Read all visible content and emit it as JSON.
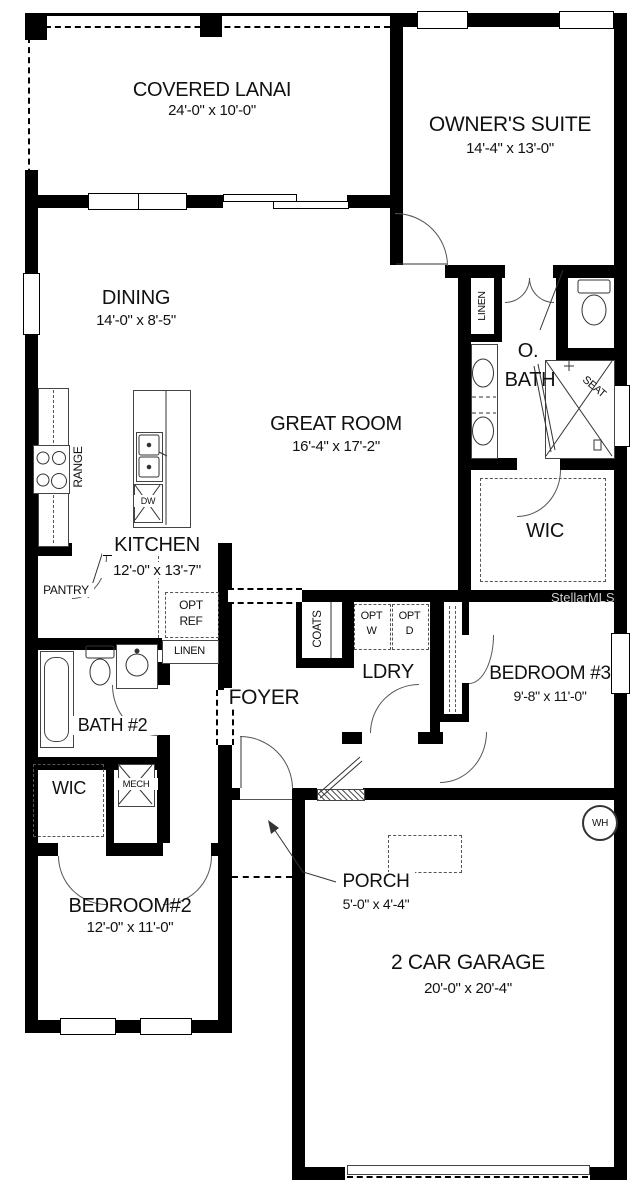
{
  "watermark": "StellarMLS",
  "rooms": {
    "lanai": {
      "name": "COVERED LANAI",
      "dims": "24'-0\" x 10'-0\""
    },
    "owners_suite": {
      "name": "OWNER'S SUITE",
      "dims": "14'-4\" x 13'-0\""
    },
    "dining": {
      "name": "DINING",
      "dims": "14'-0\" x 8'-5\""
    },
    "great_room": {
      "name": "GREAT ROOM",
      "dims": "16'-4\" x 17'-2\""
    },
    "kitchen": {
      "name": "KITCHEN",
      "dims": "12'-0\" x 13'-7\""
    },
    "owners_bath": {
      "line1": "O.",
      "line2": "BATH"
    },
    "owners_wic": {
      "name": "WIC"
    },
    "laundry": {
      "name": "LDRY"
    },
    "foyer": {
      "name": "FOYER"
    },
    "bedroom3": {
      "name": "BEDROOM #3",
      "dims": "9'-8\" x 11'-0\""
    },
    "bath2": {
      "name": "BATH #2"
    },
    "wic2": {
      "name": "WIC"
    },
    "bedroom2": {
      "name": "BEDROOM#2",
      "dims": "12'-0\" x 11'-0\""
    },
    "porch": {
      "name": "PORCH",
      "dims": "5'-0\" x 4'-4\""
    },
    "garage": {
      "name": "2 CAR GARAGE",
      "dims": "20'-0\" x 20'-4\""
    }
  },
  "labels": {
    "range": "RANGE",
    "dw": "DW",
    "pantry": "PANTRY",
    "opt_ref": {
      "line1": "OPT",
      "line2": "REF"
    },
    "linen_hall": "LINEN",
    "linen_bath": "LINEN",
    "coats": "COATS",
    "opt_w": {
      "line1": "OPT",
      "line2": "W"
    },
    "opt_d": {
      "line1": "OPT",
      "line2": "D"
    },
    "seat": "SEAT",
    "mech": "MECH",
    "wh": "WH"
  }
}
